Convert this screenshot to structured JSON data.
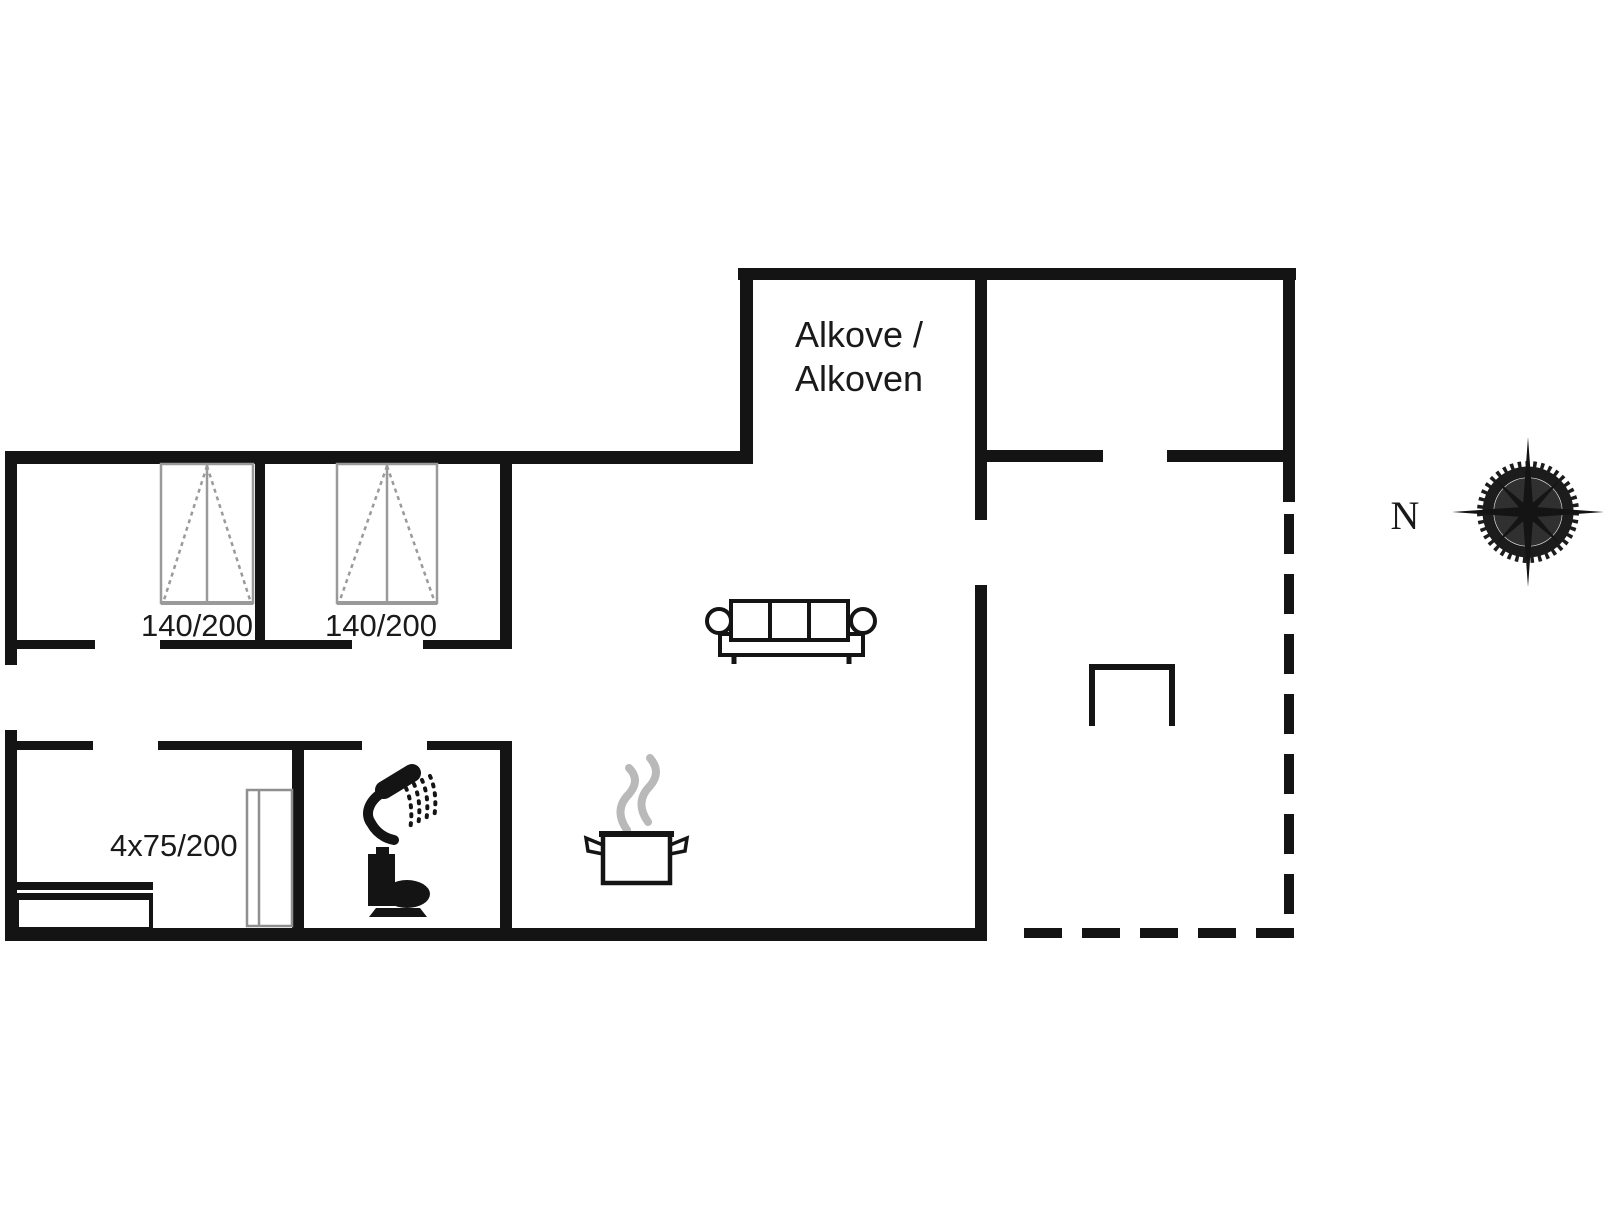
{
  "page": {
    "background": "#ffffff",
    "wall_color": "#141414",
    "furniture_gray": "#969696",
    "steam_gray": "#b9b9b9",
    "text_color": "#1a1a1a"
  },
  "floorplan": {
    "labels": {
      "alcove_line1": "Alkove /",
      "alcove_line2": "Alkoven",
      "bedroom1_bed_size": "140/200",
      "bedroom2_bed_size": "140/200",
      "bunk_room_bed_size": "4x75/200",
      "compass_north": "N"
    },
    "icons": {
      "double_bed": "double-bed-icon",
      "bunk_bed": "bunk-bed-icon",
      "wardrobe": "wardrobe-icon",
      "sofa": "sofa-icon",
      "cooking_pot": "cooking-pot-icon",
      "steam": "steam-icon",
      "shower": "shower-icon",
      "toilet": "toilet-icon",
      "terrace_chair": "chair-icon",
      "compass": "compass-rose-icon"
    }
  }
}
